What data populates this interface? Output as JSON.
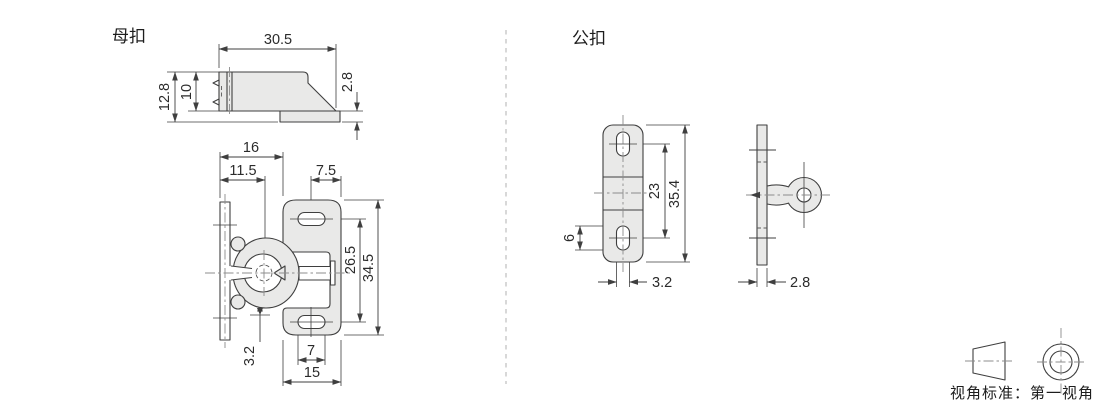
{
  "drawing": {
    "female": {
      "label": "母扣",
      "side_view": {
        "width": "30.5",
        "overall_height": "12.8",
        "body_height": "10",
        "lip_height": "2.8"
      },
      "top_view": {
        "edge_to_plate": "16",
        "edge_to_clip_center": "11.5",
        "slot_center_to_edge": "7.5",
        "slot_spacing": "26.5",
        "plate_length": "34.5",
        "clip_clearance": "3.2",
        "slot_length": "7",
        "plate_width": "15"
      }
    },
    "male": {
      "label": "公扣",
      "front_view": {
        "slot_spacing": "23",
        "plate_length": "35.4",
        "slot_length": "6",
        "slot_width": "3.2"
      },
      "side_view": {
        "plate_thickness": "2.8"
      }
    },
    "footer": {
      "projection_note": "视角标准：第一视角"
    },
    "colors": {
      "outline": "#3f3f3f",
      "part_fill": "#e9e9e8",
      "centerline": "#8c8c8c",
      "divider": "#cccccc",
      "background": "#ffffff"
    }
  }
}
